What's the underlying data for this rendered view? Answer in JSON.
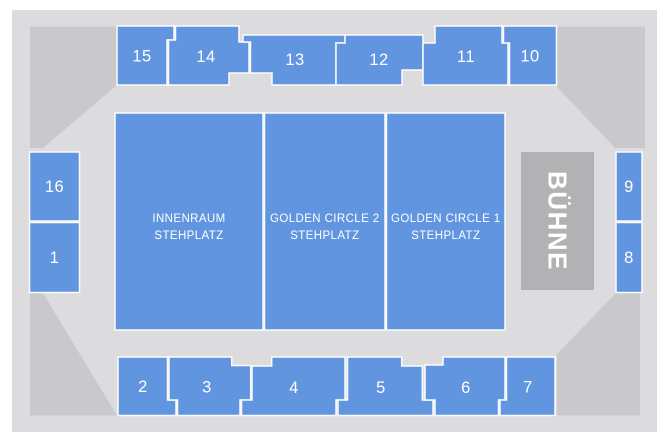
{
  "map": {
    "stage": {
      "label": "BÜHNE"
    },
    "standing_areas": {
      "innenraum": {
        "lines": [
          "INNENRAUM",
          "STEHPLATZ"
        ]
      },
      "golden_circle_2": {
        "lines": [
          "GOLDEN CIRCLE 2",
          "STEHPLATZ"
        ]
      },
      "golden_circle_1": {
        "lines": [
          "GOLDEN CIRCLE 1",
          "STEHPLATZ"
        ]
      }
    },
    "sections": {
      "s1": {
        "label": "1"
      },
      "s2": {
        "label": "2"
      },
      "s3": {
        "label": "3"
      },
      "s4": {
        "label": "4"
      },
      "s5": {
        "label": "5"
      },
      "s6": {
        "label": "6"
      },
      "s7": {
        "label": "7"
      },
      "s8": {
        "label": "8"
      },
      "s9": {
        "label": "9"
      },
      "s10": {
        "label": "10"
      },
      "s11": {
        "label": "11"
      },
      "s12": {
        "label": "12"
      },
      "s13": {
        "label": "13"
      },
      "s14": {
        "label": "14"
      },
      "s15": {
        "label": "15"
      },
      "s16": {
        "label": "16"
      }
    },
    "colors": {
      "section_blue": "#6295e0",
      "floor_gray": "#dcdcde",
      "corner_gray": "#c9c9cb",
      "stage_gray": "#b2b2b4",
      "label_white": "#ffffff",
      "page_background": "#ffffff"
    }
  }
}
